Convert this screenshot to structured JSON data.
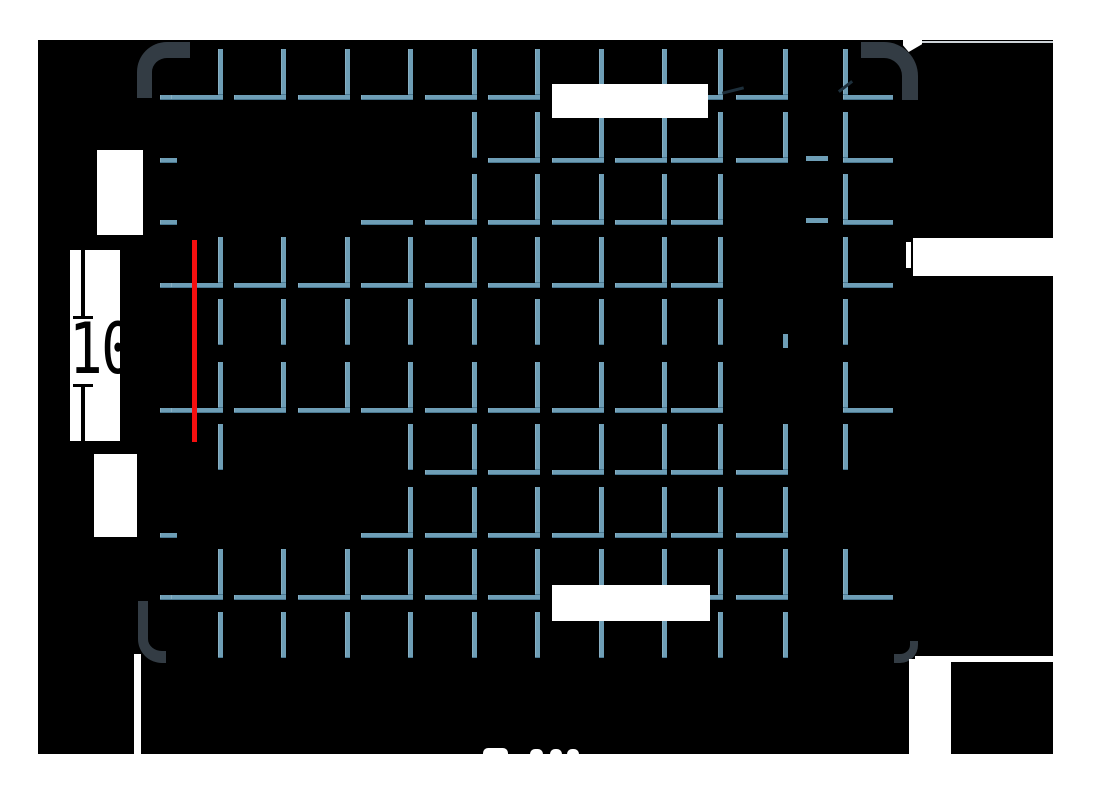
{
  "title": "pallet-top-view-drawing",
  "colors": {
    "page_bg": "#ffffff",
    "canvas_bg": "#000000",
    "grid_blue": "#6e9eb6",
    "grid_blue_shadow": "#4a7891",
    "corner_gray": "#333c44",
    "highlight_red": "#f50f0f",
    "extension_gray": "#cdd2d7",
    "dimension_ink": "#000000"
  },
  "canvas": {
    "x": 38,
    "y": 40,
    "w": 1015,
    "h": 714
  },
  "grid": {
    "cols": [
      218,
      281,
      345,
      408,
      472,
      535,
      599,
      662,
      718,
      783
    ],
    "right_col": 843,
    "v_w": 5,
    "v_len": 46,
    "h_w": 5,
    "h_len": 52,
    "right_h_len": 50,
    "edge_x": 160,
    "edge_len_long": 48,
    "edge_len_short": 17,
    "rows": [
      {
        "y": 97,
        "edge": 2,
        "cells": "LLLLLLLLLL",
        "right": "R"
      },
      {
        "y": 160,
        "edge": 1,
        "cells": "....VLLLLL",
        "right": "R"
      },
      {
        "y": 222,
        "edge": 1,
        "cells": "...HLLLLL.",
        "right": "R"
      },
      {
        "y": 285,
        "edge": 2,
        "cells": "LLLLLLLLL.",
        "right": "R"
      },
      {
        "y": 347,
        "edge": 0,
        "cells": "VVVVVVVVV.",
        "right": "V"
      },
      {
        "y": 410,
        "edge": 2,
        "cells": "LLLLLLLLL.",
        "right": "R"
      },
      {
        "y": 472,
        "edge": 0,
        "cells": "V..VLLLLLL",
        "right": "V"
      },
      {
        "y": 535,
        "edge": 1,
        "cells": "...LLLLLLL",
        "right": "."
      },
      {
        "y": 597,
        "edge": 2,
        "cells": "LLLLLLLLLL",
        "right": "R"
      },
      {
        "y": 660,
        "edge": 0,
        "cells": "VVVVVVVVVV",
        "right": "."
      }
    ],
    "fragments": [
      {
        "x": 783,
        "y": 334,
        "w": 5,
        "h": 14
      },
      {
        "x": 806,
        "y": 156,
        "w": 22,
        "h": 5
      },
      {
        "x": 806,
        "y": 218,
        "w": 22,
        "h": 5
      }
    ]
  },
  "corners": [
    {
      "name": "pallet-corner-top-left",
      "x": 137,
      "y": 42,
      "w": 53,
      "h": 56,
      "bw": "16px 0 0 15px",
      "rad": "30px 0 0 0"
    },
    {
      "name": "pallet-corner-top-right",
      "x": 861,
      "y": 42,
      "w": 57,
      "h": 58,
      "bw": "16px 16px 0 0",
      "rad": "0 34px 0 0"
    },
    {
      "name": "pallet-corner-bottom-left",
      "x": 138,
      "y": 601,
      "w": 28,
      "h": 62,
      "bw": "0 0 12px 10px",
      "rad": "0 0 0 24px"
    },
    {
      "name": "pallet-corner-bottom-right",
      "x": 894,
      "y": 641,
      "w": 24,
      "h": 22,
      "bw": "0 8px 9px 0",
      "rad": "0 0 18px 0"
    }
  ],
  "overlays": {
    "white_boxes": [
      {
        "name": "dimension-label-top",
        "x": 552,
        "y": 84,
        "w": 156,
        "h": 34
      },
      {
        "name": "dimension-label-bottom",
        "x": 552,
        "y": 585,
        "w": 158,
        "h": 36
      },
      {
        "name": "dimension-label-right",
        "x": 913,
        "y": 238,
        "w": 140,
        "h": 38
      },
      {
        "name": "dimension-tick-right",
        "x": 906,
        "y": 242,
        "w": 5,
        "h": 26
      },
      {
        "name": "dimension-label-upper-left",
        "x": 97,
        "y": 150,
        "w": 46,
        "h": 85
      },
      {
        "name": "dimension-label-lower-left",
        "x": 94,
        "y": 454,
        "w": 43,
        "h": 83
      }
    ],
    "white_lines": [
      {
        "name": "extension-line-bottom-left",
        "x": 134,
        "y": 654,
        "w": 7,
        "h": 100
      },
      {
        "name": "extension-strip-bottom-right",
        "x": 909,
        "y": 659,
        "w": 42,
        "h": 95
      },
      {
        "name": "extension-seam-bottom-right",
        "x": 915,
        "y": 656,
        "w": 138,
        "h": 6
      }
    ],
    "gray_line": {
      "name": "extension-line-top-right",
      "x": 920,
      "y": 41,
      "w": 133,
      "h": 2
    },
    "notch": {
      "name": "corner-notch-top-right",
      "x": 903,
      "y": 40,
      "w": 19,
      "h": 12
    },
    "red_line": {
      "name": "highlighted-edge",
      "x": 192,
      "y": 240,
      "w": 5,
      "h": 202
    },
    "bumps": [
      {
        "x": 483,
        "y": 748,
        "w": 25,
        "h": 8
      },
      {
        "x": 530,
        "y": 749,
        "w": 13,
        "h": 7
      },
      {
        "x": 550,
        "y": 749,
        "w": 12,
        "h": 7
      },
      {
        "x": 567,
        "y": 749,
        "w": 12,
        "h": 7
      }
    ],
    "artifacts": [
      {
        "x": 560,
        "y": 87,
        "w": 27,
        "h": 3,
        "rot": -8
      },
      {
        "x": 722,
        "y": 89,
        "w": 22,
        "h": 3,
        "rot": -14
      },
      {
        "x": 837,
        "y": 85,
        "w": 17,
        "h": 3,
        "rot": -38
      }
    ]
  },
  "dimension": {
    "text": "10",
    "box": {
      "x": 70,
      "y": 250,
      "w": 50,
      "h": 191
    },
    "line_segments": [
      {
        "x": 11,
        "y": 0,
        "w": 4,
        "h": 68
      },
      {
        "x": 11,
        "y": 136,
        "w": 4,
        "h": 55
      }
    ],
    "ticks": [
      {
        "x": 3,
        "y": 66,
        "w": 20,
        "h": 3
      },
      {
        "x": 3,
        "y": 134,
        "w": 20,
        "h": 3
      }
    ],
    "text_pos": {
      "x": -1,
      "y": 64
    }
  }
}
